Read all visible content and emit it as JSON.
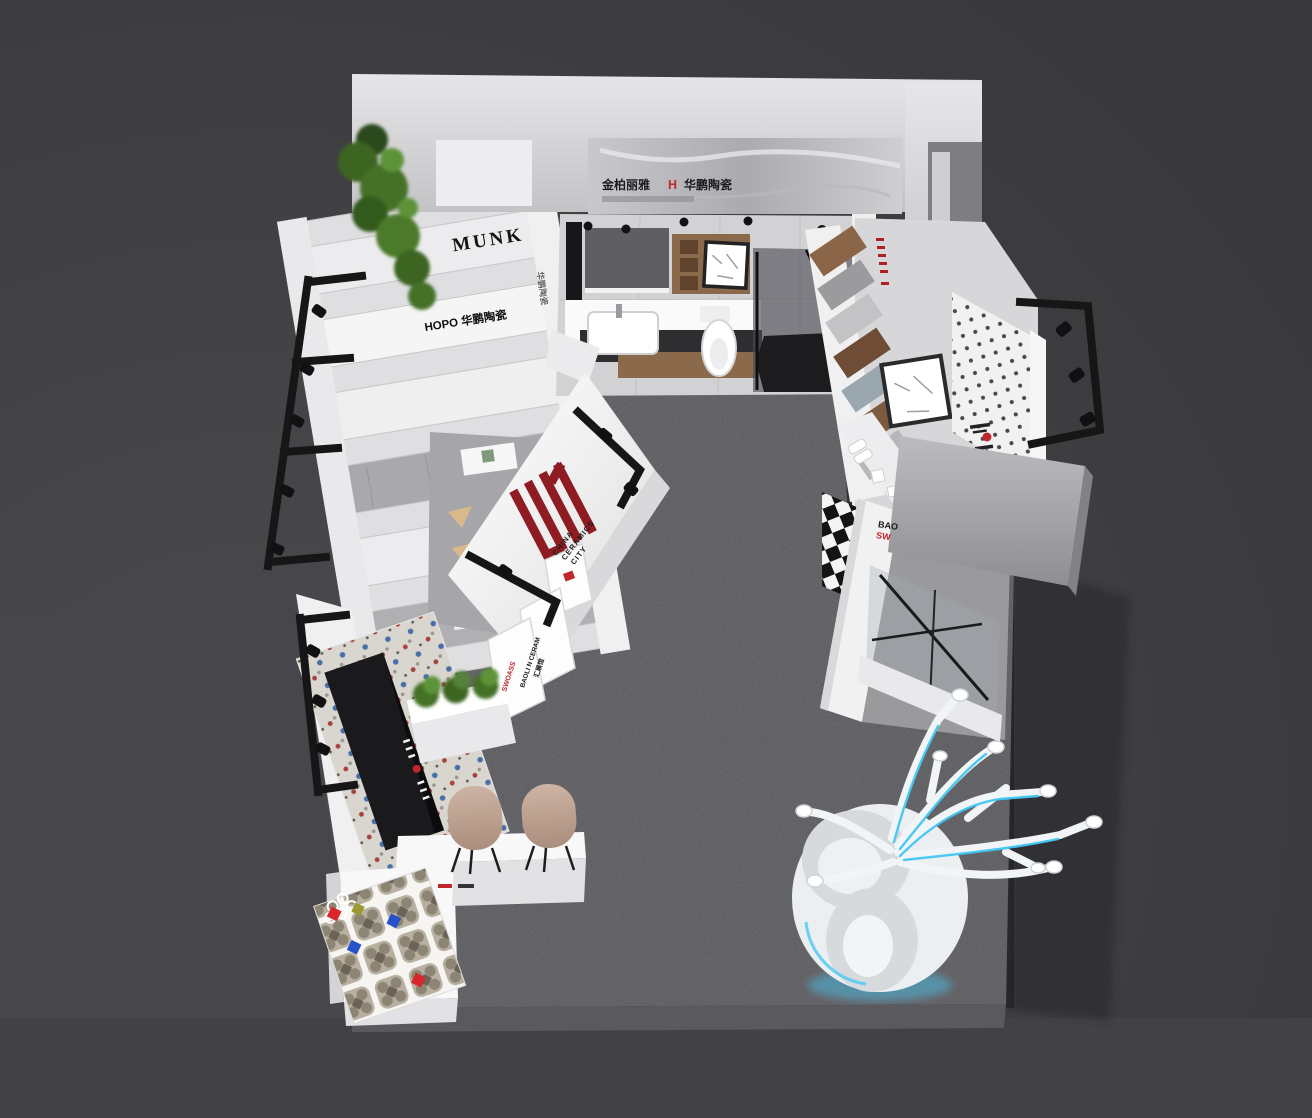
{
  "scene_title": "ceramics exhibition booth 3D bird's-eye render",
  "palette": {
    "brand_red": "#8e1c22",
    "text_red": "#c0272d",
    "led_blue": "#3fc6f2",
    "wall_white": "#f2f2f3",
    "carpet_gray": "#85858a",
    "hall_dark": "#39393c"
  },
  "signs": {
    "header": {
      "left": "金柏丽雅",
      "mark": "H",
      "right": "华鹏陶瓷"
    },
    "munk": "MUNK",
    "hopo": "HOPO 华鹏陶瓷",
    "vertical_wall": "华鹏陶瓷",
    "bao": "BAO",
    "sw": "SW",
    "feature_caption": [
      "CHINA",
      "CERAMICS",
      "CITY"
    ],
    "plinths": {
      "red": "SWOASS",
      "black": "BAOLI N CERAM",
      "cn": "汇展馆"
    }
  }
}
